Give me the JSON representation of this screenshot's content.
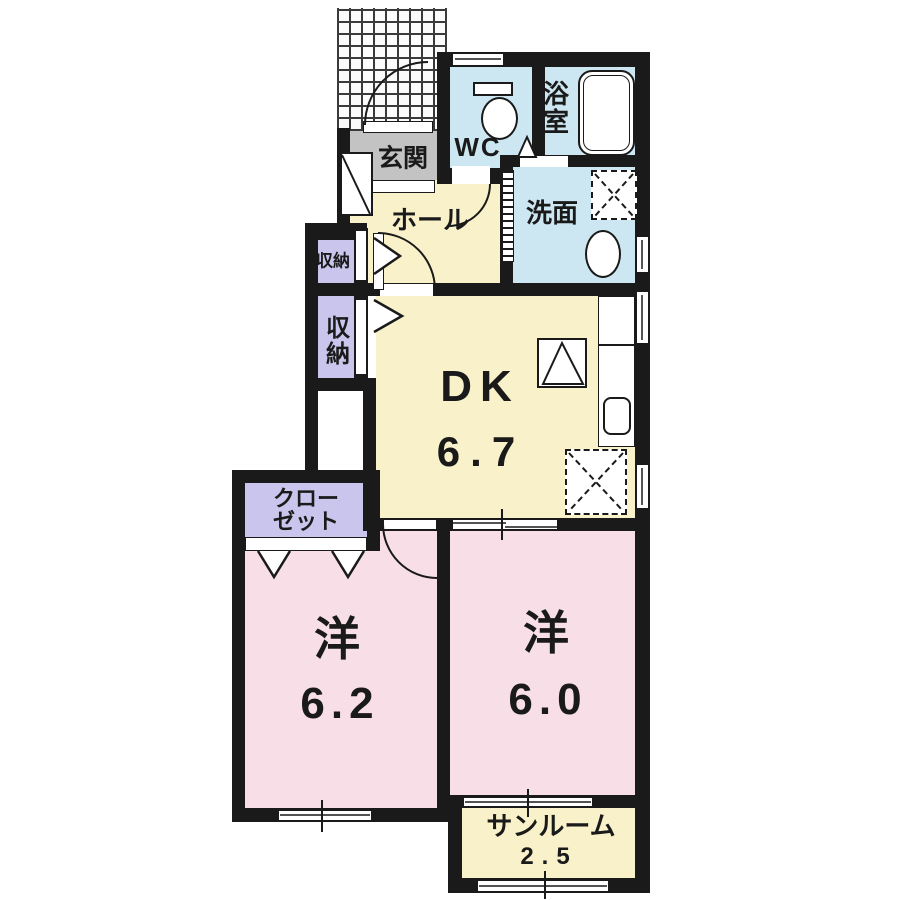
{
  "plan": {
    "type": "apartment-floor-plan",
    "colors": {
      "wall": "#1a1a1a",
      "room_cream": "#f8f1c9",
      "room_pink": "#f8dee7",
      "room_blue": "#cde7f2",
      "storage_lavender": "#c9c5ec",
      "entrance_gray": "#c3c3c3",
      "background": "#ffffff"
    },
    "rooms": {
      "entrance": {
        "label": "玄関"
      },
      "wc": {
        "label": "WC"
      },
      "bath": {
        "label": "浴室"
      },
      "washroom": {
        "label": "洗面"
      },
      "hall": {
        "label": "ホール"
      },
      "storage_upper": {
        "label": "収納"
      },
      "storage_lower": {
        "label": "収納"
      },
      "dining_kitchen": {
        "label": "DK",
        "size": "6.7"
      },
      "closet": {
        "label_line1": "クロー",
        "label_line2": "ゼット"
      },
      "western_room_left": {
        "label": "洋",
        "size": "6.2"
      },
      "western_room_right": {
        "label": "洋",
        "size": "6.0"
      },
      "sunroom": {
        "label": "サンルーム",
        "size": "2.5"
      }
    },
    "fixtures": [
      "entrance-porch-tiles",
      "shoe-cabinet",
      "toilet",
      "bathtub",
      "vanity-sink",
      "washer-space",
      "kitchen-counter",
      "kitchen-sink",
      "stove",
      "appliance-space",
      "entrance-door",
      "wc-door",
      "bath-door",
      "accordion-door",
      "hall-dk-door",
      "dk-room-door",
      "sliding-door",
      "closet-folding-door",
      "windows"
    ]
  }
}
